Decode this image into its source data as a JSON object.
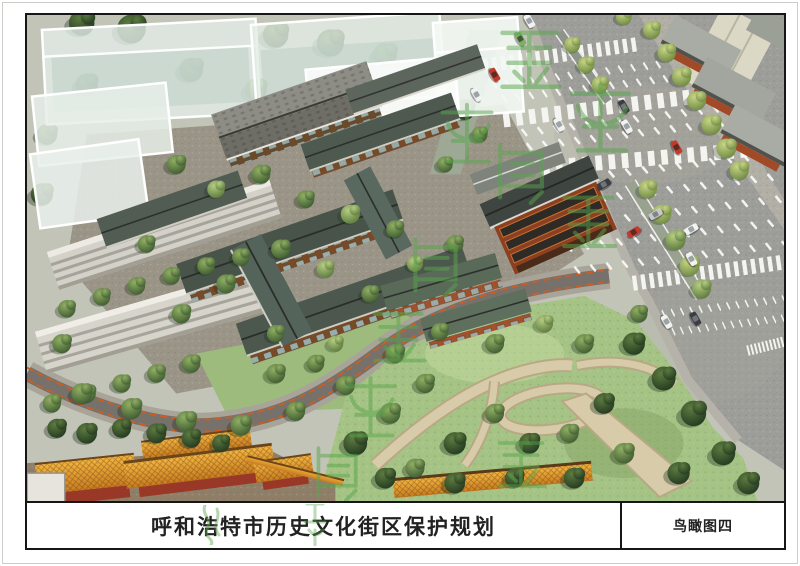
{
  "sheet": {
    "title_bar": {
      "project_title": "呼和浩特市历史文化街区保护规划",
      "sheet_label": "鸟瞰图四"
    },
    "rendering": {
      "kind": "aerial-birdseye-rendering",
      "sheet_number_visible": "鸟瞰图四"
    },
    "palette": {
      "frame_black": "#161616",
      "road_gray": "#9d9d99",
      "park_grass": "#a6c386",
      "historic_roof": "#4e5a50",
      "temple_roof_orange": "#dd9a2e",
      "temple_wall_red": "#993826",
      "red_building": "#8d3f22",
      "ghost_building_white": "#e9f0ea",
      "watermark_green": "#58a64b",
      "crosswalk_white": "#f4f4f0"
    }
  }
}
